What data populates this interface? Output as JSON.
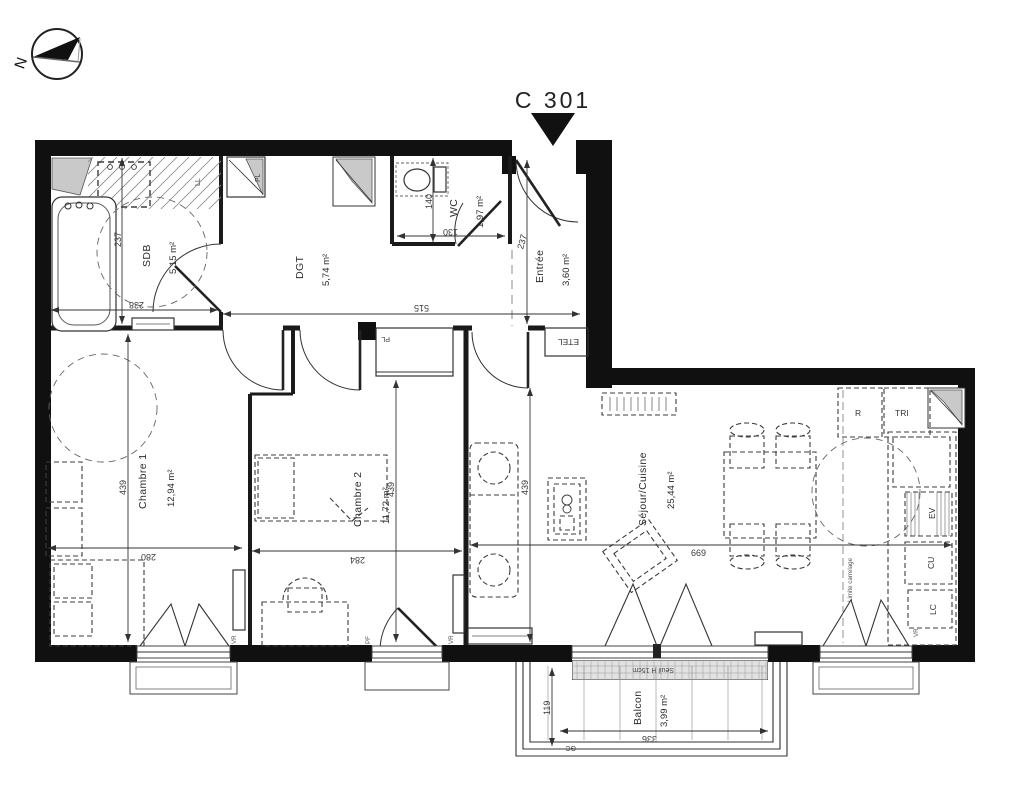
{
  "title": {
    "unit_label": "C 301"
  },
  "compass": {
    "north_letter": "N"
  },
  "rooms": {
    "sdb": {
      "name": "SDB",
      "area": "5,15 m²"
    },
    "dgt": {
      "name": "DGT",
      "area": "5,74 m²"
    },
    "wc": {
      "name": "WC",
      "area": "1,97 m²"
    },
    "entree": {
      "name": "Entrée",
      "area": "3,60 m²"
    },
    "chambre1": {
      "name": "Chambre 1",
      "area": "12,94 m²"
    },
    "chambre2": {
      "name": "Chambre 2",
      "area": "11,72 m²"
    },
    "sejour": {
      "name": "Séjour/Cuisine",
      "area": "25,44 m²"
    },
    "balcon": {
      "name": "Balcon",
      "area": "3,99 m²"
    }
  },
  "dimensions": {
    "sdb_height": "237",
    "sdb_width": "238",
    "corridor_width": "515",
    "wc_height": "140",
    "wc_width": "130",
    "entree_height": "237",
    "chambre1_height": "439",
    "chambre1_width": "280",
    "chambre2_height": "439",
    "chambre2_width": "284",
    "sejour_height": "439",
    "sejour_width": "669",
    "balcon_height": "119",
    "balcon_width": "336"
  },
  "annotations": {
    "washer": "LL",
    "closet_top": "PL",
    "closet_hall": "PL",
    "etel": "ETEL",
    "fridge": "R",
    "waste": "TRI",
    "sink": "EV",
    "cooktop": "CU",
    "dishwasher": "LC",
    "shutter": "VR",
    "french_door": "PF",
    "threshold": "Seuil H 15cm",
    "railing": "GC",
    "tile_limit": "Limite carrelage"
  }
}
